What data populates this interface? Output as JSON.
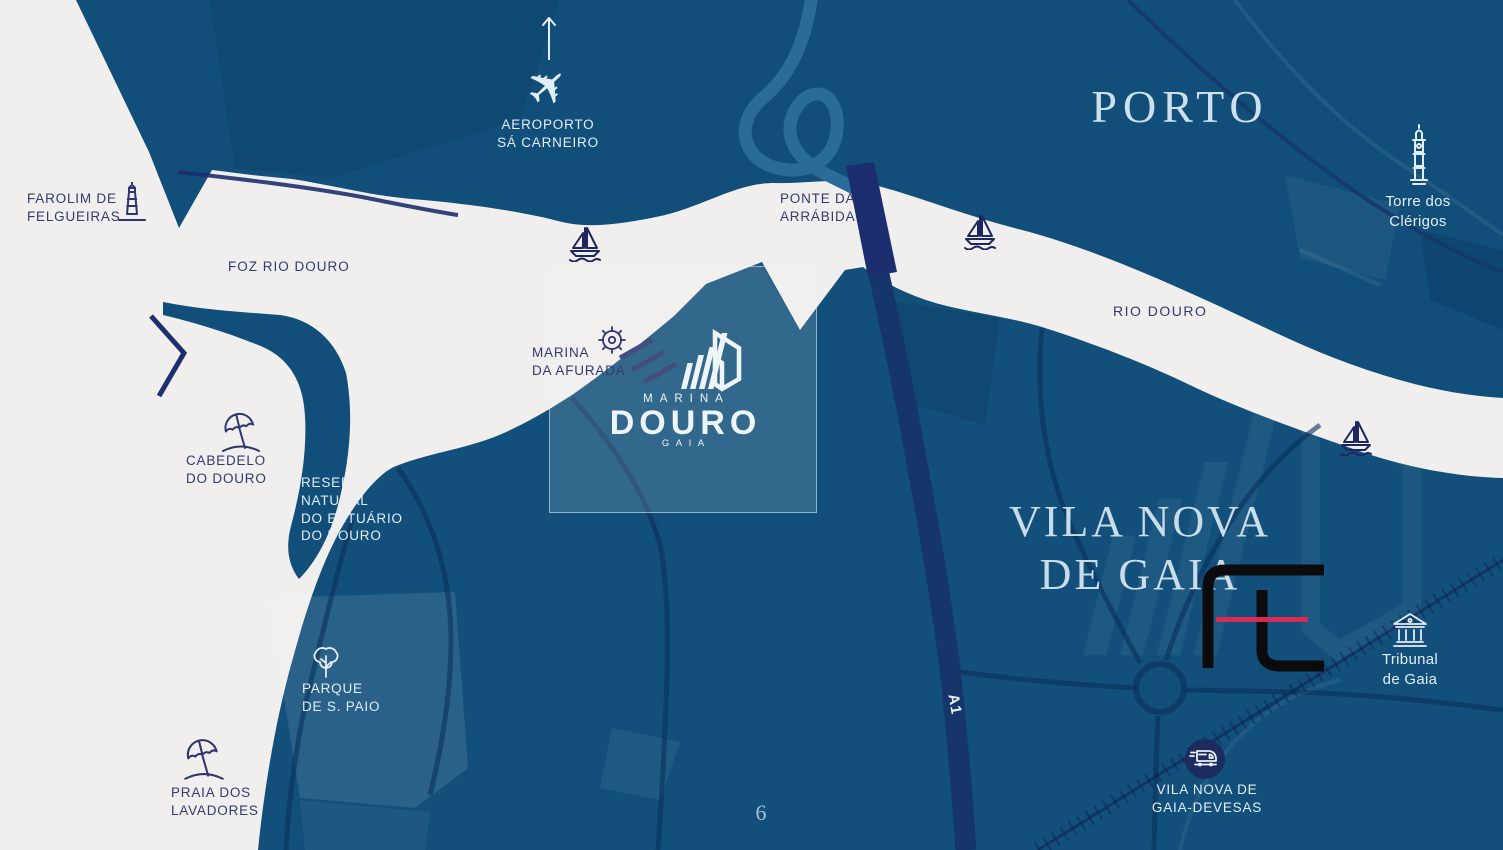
{
  "page": {
    "number": "6"
  },
  "titles": {
    "north_city": "PORTO",
    "south_city": "VILA NOVA\nDE GAIA"
  },
  "logo": {
    "line1": "MARINA",
    "line2": "DOURO",
    "line3": "GAIA"
  },
  "labels": {
    "farolim": "FAROLIM DE\nFELGUEIRAS",
    "foz_rio_douro": "FOZ RIO DOURO",
    "aeroporto": "AEROPORTO\nSÁ CARNEIRO",
    "ponte_arrabida": "PONTE DA\nARRÁBIDA",
    "torre_clerigos": "Torre dos\nClérigos",
    "rio_douro": "RIO DOURO",
    "marina_afurada": "MARINA\nDA AFURADA",
    "cabedelo": "CABEDELO\nDO DOURO",
    "reserva_natural": "RESERVA\nNATURAL\nDO ESTUÁRIO\nDO DOURO",
    "parque_s_paio": "PARQUE\nDE S. PAIO",
    "praia_lavadores": "PRAIA DOS\nLAVADORES",
    "a1": "A1",
    "gaia_devesas": "VILA NOVA DE\nGAIA-DEVESAS",
    "tribunal_gaia": "Tribunal\nde Gaia"
  },
  "icons": {
    "airplane_glyph": "✈"
  },
  "colors": {
    "water": "#f0efed",
    "land": "#114e79",
    "road_dark": "#16366b",
    "bridge": "#1c2e6e",
    "highway_loop": "#2b6b98",
    "label_navy": "#333a6e",
    "label_white": "#e3edf4",
    "serif_title": "#cfe0ec",
    "logo_accent_red": "#da2a52",
    "watermark_black": "#0b0b0d",
    "station_badge": "#1d2c5f"
  }
}
